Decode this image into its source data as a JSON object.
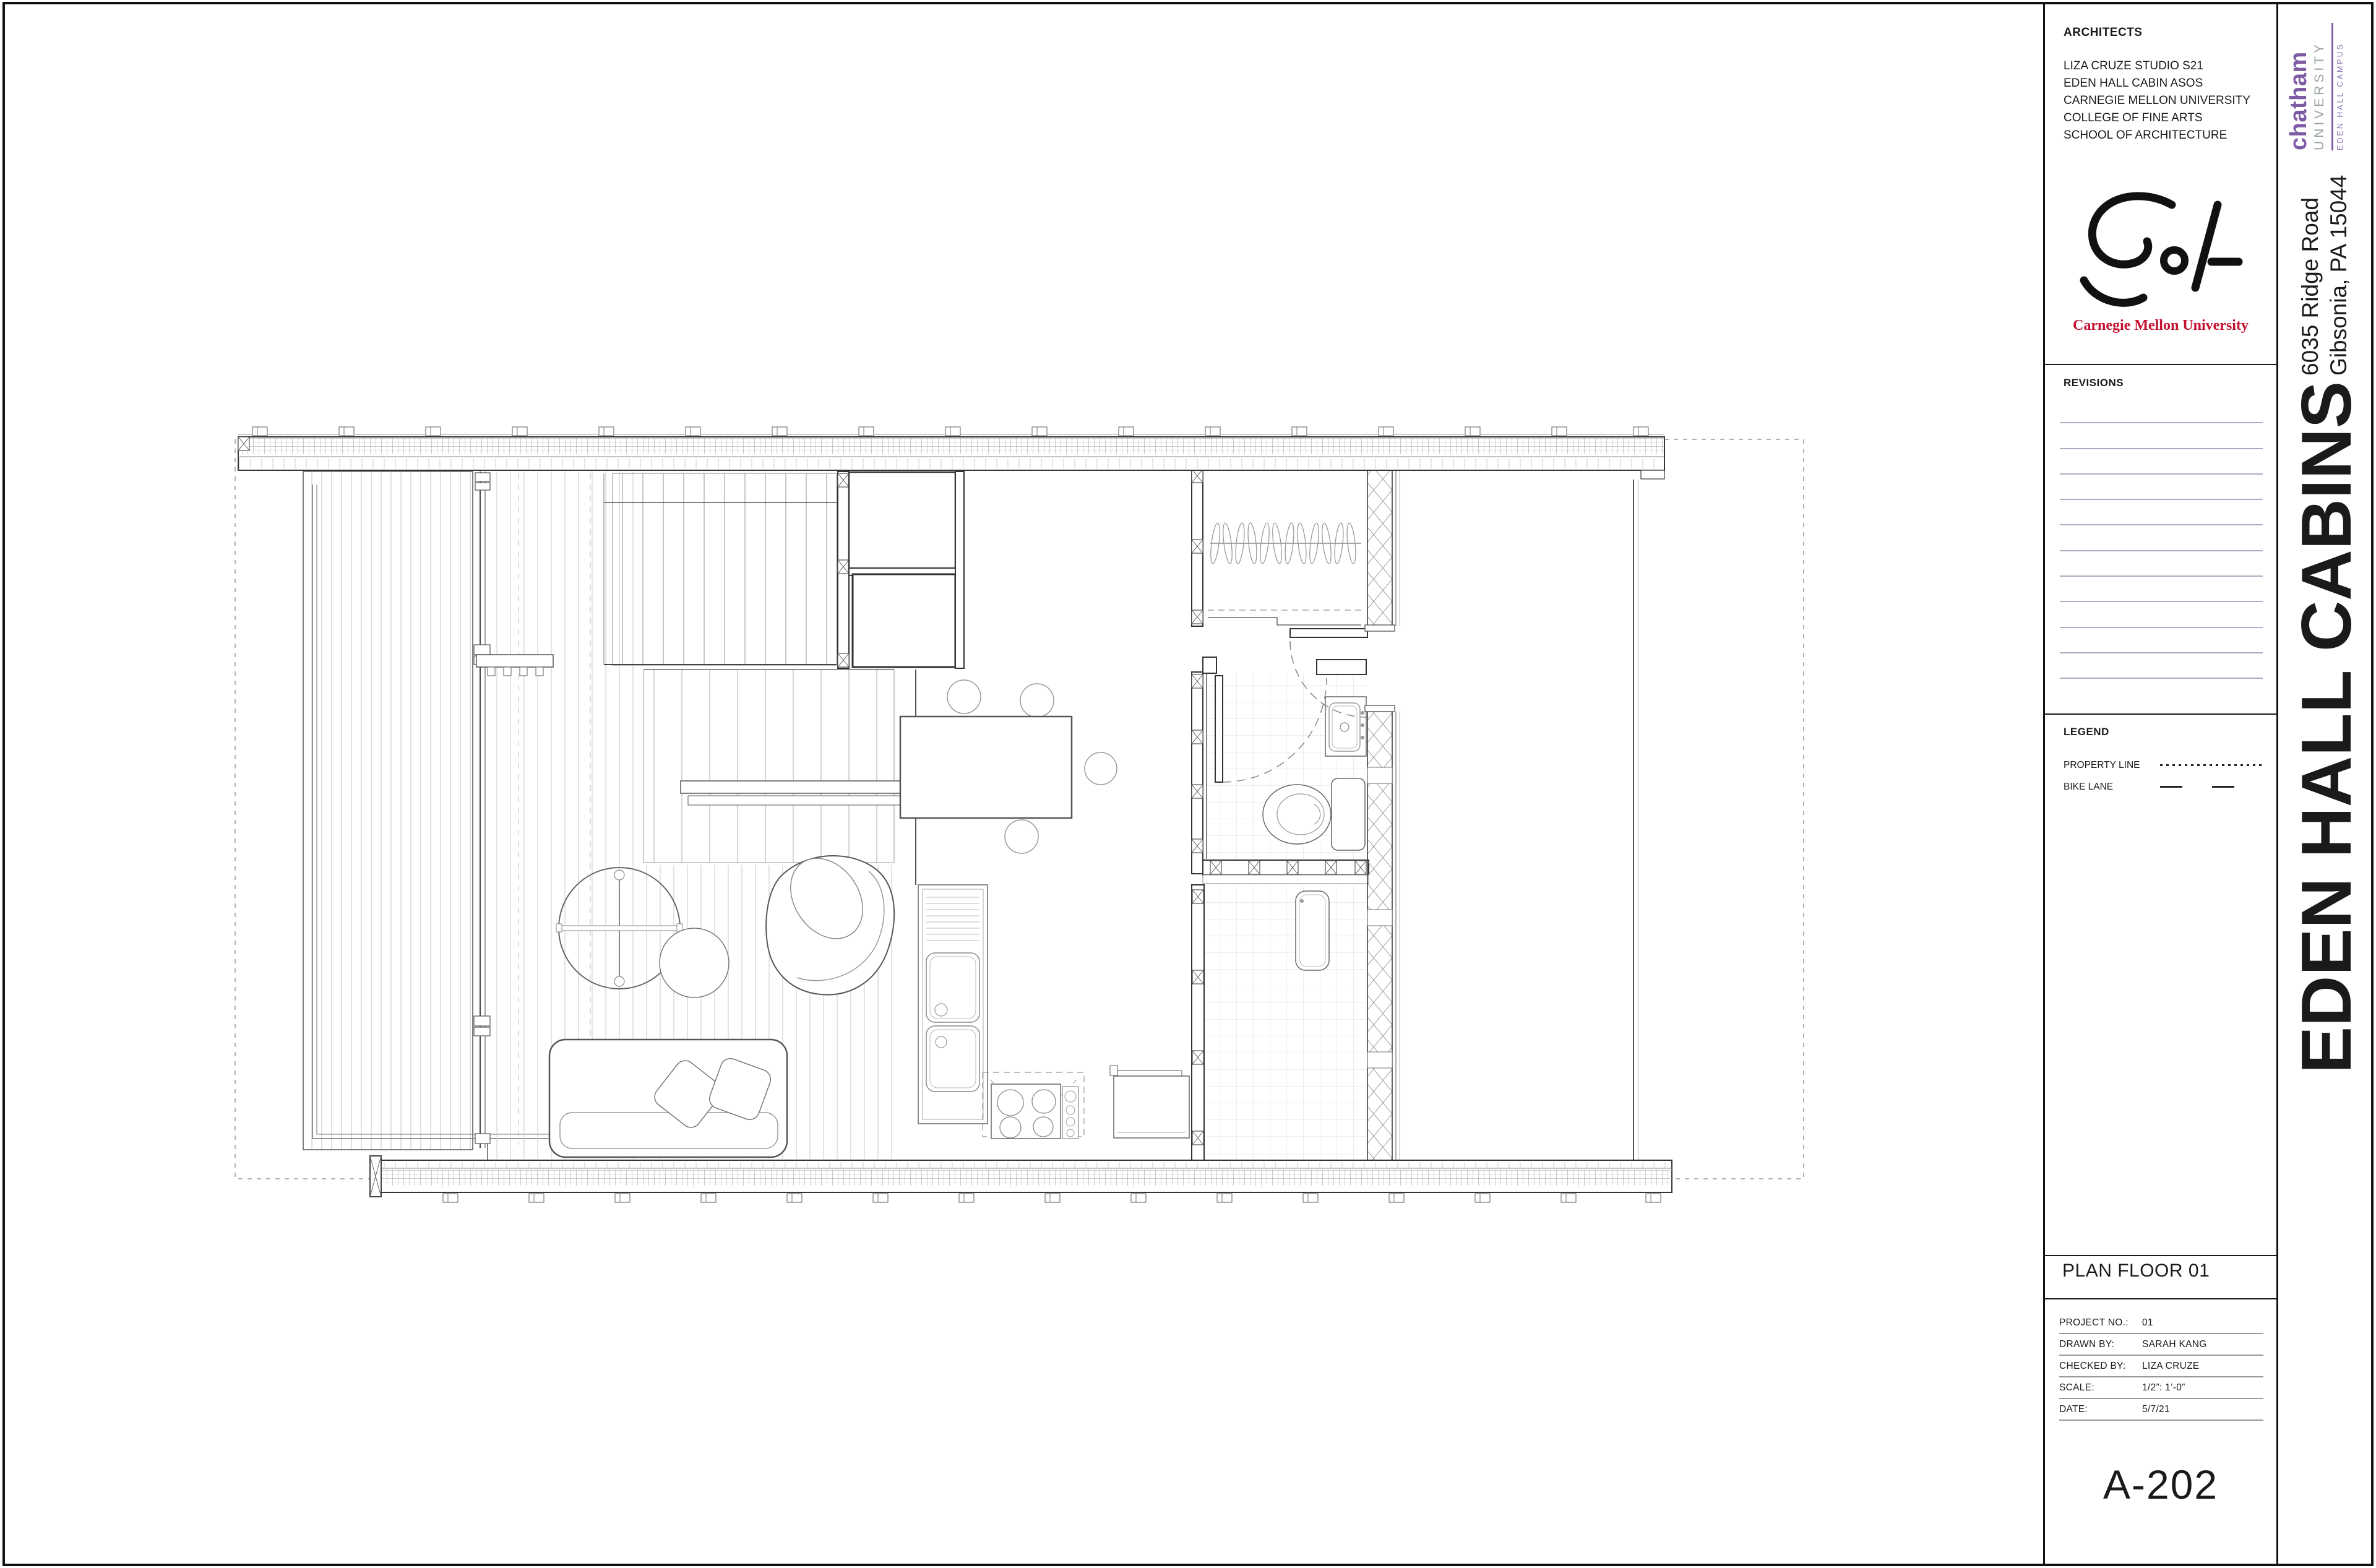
{
  "sheet": {
    "architects": {
      "label": "ARCHITECTS",
      "lines": "LIZA CRUZE STUDIO S21\nEDEN HALL CABIN ASOS\nCARNEGIE MELLON UNIVERSITY\nCOLLEGE OF FINE ARTS\nSCHOOL OF ARCHITECTURE"
    },
    "cmu_logo": {
      "wordmark": "Carnegie Mellon University",
      "red": "#C41230"
    },
    "chatham": {
      "name": "chatham",
      "university": "UNIVERSITY",
      "campus": "EDEN HALL CAMPUS",
      "purple": "#7E5CA5",
      "gray": "#97A1A5"
    },
    "address": {
      "line1": "6035 Ridge Road",
      "line2": "Gibsonia, PA 15044"
    },
    "project_title": "EDEN HALL CABINS",
    "revisions": {
      "label": "REVISIONS",
      "rows": 11,
      "line_color": "#a9afc3"
    },
    "legend": {
      "label": "LEGEND",
      "items": [
        {
          "name": "PROPERTY LINE",
          "style": "dotted"
        },
        {
          "name": "BIKE LANE",
          "style": "dashed"
        }
      ]
    },
    "titleblock": {
      "drawing_title": "PLAN FLOOR 01",
      "fields": [
        {
          "label": "PROJECT NO.:",
          "value": "01"
        },
        {
          "label": "DRAWN BY:",
          "value": "SARAH KANG"
        },
        {
          "label": "CHECKED BY:",
          "value": "LIZA CRUZE"
        },
        {
          "label": "SCALE:",
          "value": "1/2”: 1’-0”"
        },
        {
          "label": "DATE:",
          "value": "5/7/21"
        }
      ],
      "sheet_number": "A-202"
    }
  }
}
